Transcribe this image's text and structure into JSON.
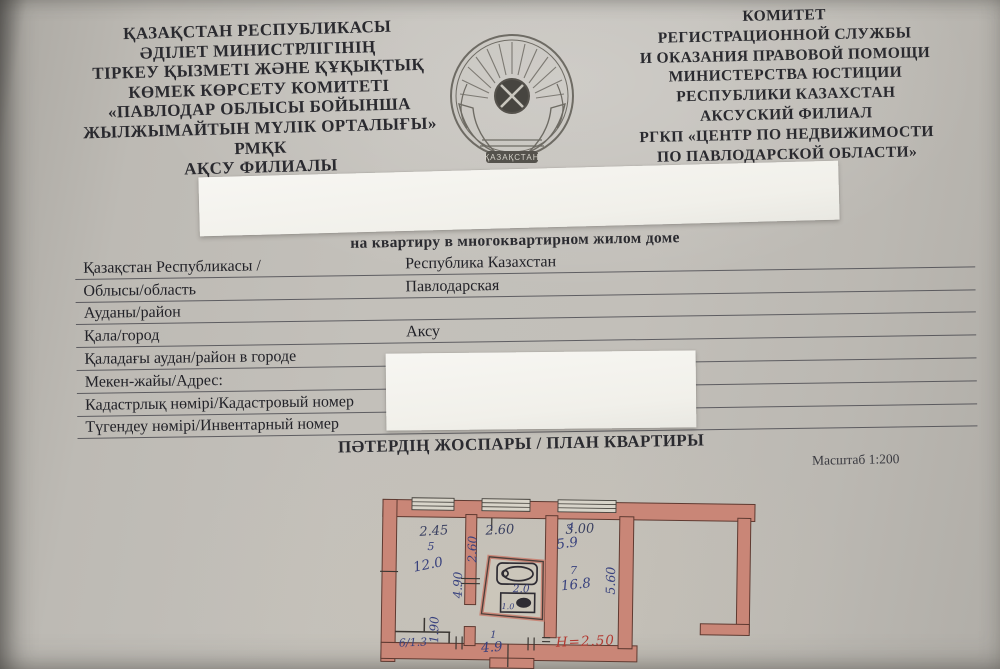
{
  "header_left": {
    "lines": [
      "ҚАЗАҚСТАН РЕСПУБЛИКАСЫ",
      "ӘДІЛЕТ МИНИСТРЛІГІНІҢ",
      "ТІРКЕУ ҚЫЗМЕТІ  ЖӘНЕ ҚҰҚЫҚТЫҚ",
      "КӨМЕК КӨРСЕТУ КОМИТЕТІ",
      "«ПАВЛОДАР ОБЛЫСЫ БОЙЫНША",
      "ЖЫЛЖЫМАЙТЫН  МҮЛІК ОРТАЛЫҒЫ» РМҚК",
      "АҚСУ ФИЛИАЛЫ"
    ]
  },
  "header_right": {
    "lines": [
      "КОМИТЕТ",
      "РЕГИСТРАЦИОННОЙ СЛУЖБЫ",
      "И ОКАЗАНИЯ ПРАВОВОЙ ПОМОЩИ",
      "МИНИСТЕРСТВА ЮСТИЦИИ",
      "РЕСПУБЛИКИ КАЗАХСТАН",
      "АКСУСКИЙ ФИЛИАЛ",
      "РГКП «ЦЕНТР ПО НЕДВИЖИМОСТИ",
      "ПО ПАВЛОДАРСКОЙ ОБЛАСТИ»"
    ]
  },
  "emblem": {
    "banner": "ҚАЗАҚСТАН"
  },
  "subtitle": "на квартиру в многоквартирном жилом доме",
  "table": {
    "rows": [
      {
        "label": "Қазақстан Республикасы /",
        "value": "Республика Казахстан"
      },
      {
        "label": "Облысы/область",
        "value": "Павлодарская"
      },
      {
        "label": "Ауданы/район",
        "value": ""
      },
      {
        "label": "Қала/город",
        "value": "Аксу"
      },
      {
        "label": "Қаладағы  аудан/район в городе",
        "value": ""
      },
      {
        "label": "Мекен-жайы/Адрес:",
        "value": ""
      },
      {
        "label": "Кадастрлық нөмірі/Кадастровый номер",
        "value": ""
      },
      {
        "label": "Түгендеу нөмірі/Инвентарный номер",
        "value": ""
      }
    ]
  },
  "plan_section": {
    "title": "ПӘТЕРДІҢ ЖОСПАРЫ / ПЛАН КВАРТИРЫ",
    "scale": "Масштаб 1:200"
  },
  "plan": {
    "top_dims": [
      "2.45",
      "2.60",
      "3.00"
    ],
    "room5": {
      "number": "5",
      "area": "12.0"
    },
    "room4": {
      "number": "4",
      "area": "5.9"
    },
    "room7": {
      "number": "7",
      "area": "16.8"
    },
    "room6": {
      "label": "6/1.3"
    },
    "hall": {
      "number": "1",
      "area": "4.9"
    },
    "bath_area": "2.0",
    "toilet_area": "1.0",
    "side_dims": {
      "upper_left": "2.60",
      "mid_left": "4.90",
      "right": "5.60",
      "hall_left": "1.90"
    },
    "height_note": "Н=2.50",
    "colors": {
      "wall": "#c98677",
      "wall_stroke": "#5f3a31",
      "ink_blue": "#39427e",
      "ink_red": "#b23a32"
    }
  }
}
